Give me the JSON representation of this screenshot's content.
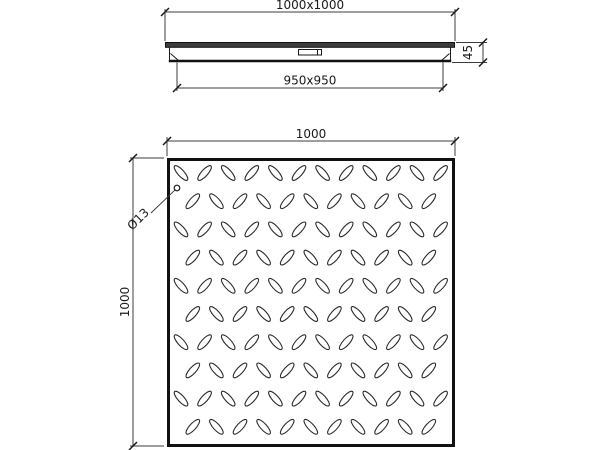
{
  "drawing": {
    "section_view": {
      "overall_dimension_label": "1000x1000",
      "clear_opening_dimension_label": "950x950",
      "height_dimension_label": "45"
    },
    "plan_view": {
      "width_dimension_label": "1000",
      "height_dimension_label": "1000",
      "stud_diameter_label": "Ø13",
      "tread_pattern": {
        "rows": 10,
        "cols_even_row": 12,
        "cols_odd_row": 11,
        "start_x": 181,
        "start_y": 173,
        "pitch_x": 23.6,
        "pitch_y": 28.2,
        "stagger_offset": 11.8,
        "ellipse_rx": 9.5,
        "ellipse_ry": 3.2,
        "angle_deg": 48
      }
    },
    "colors": {
      "line": "#1a1a1a",
      "dim_line": "#3c3c3c",
      "section_fill": "#3d3d3d",
      "background": "#ffffff"
    }
  }
}
